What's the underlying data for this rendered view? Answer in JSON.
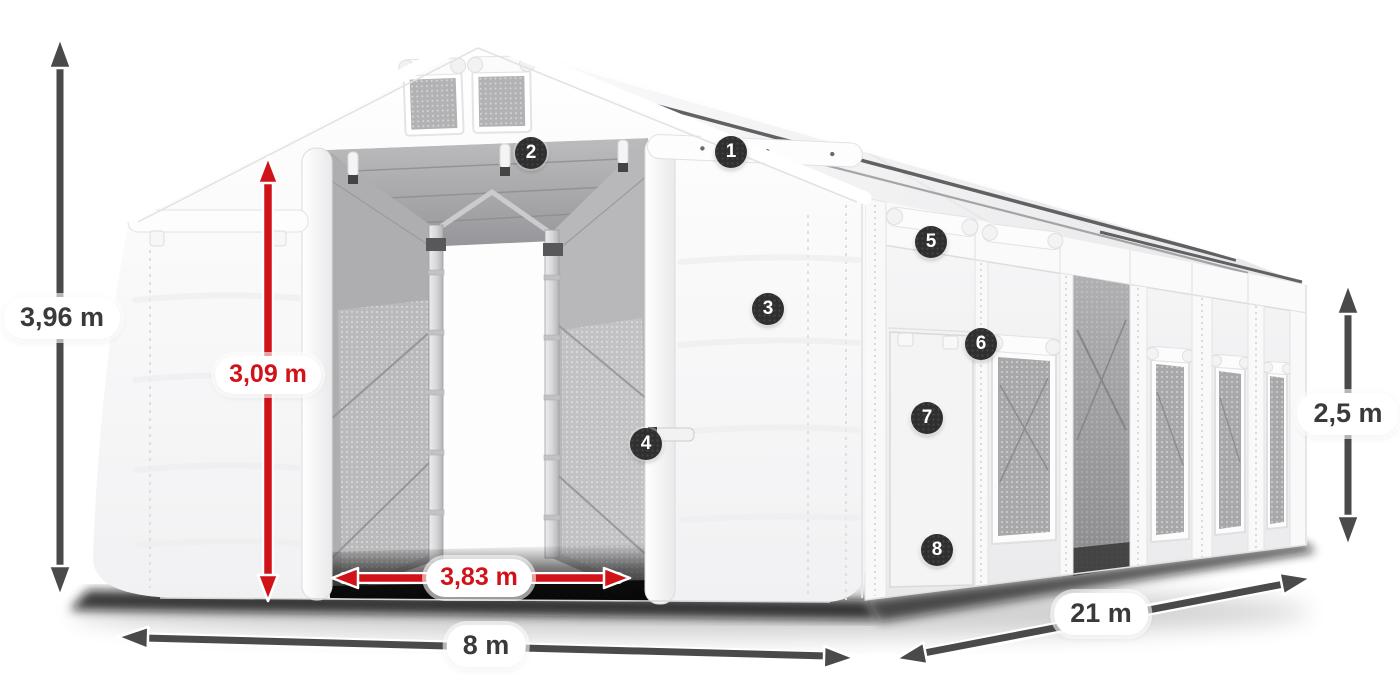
{
  "dimensions": [
    {
      "id": "total-height",
      "value": "3,96 m",
      "style": "dark"
    },
    {
      "id": "door-height",
      "value": "3,09 m",
      "style": "red"
    },
    {
      "id": "door-width",
      "value": "3,83 m",
      "style": "red"
    },
    {
      "id": "front-width",
      "value": "8 m",
      "style": "dark"
    },
    {
      "id": "side-length",
      "value": "21 m",
      "style": "dark"
    },
    {
      "id": "side-height",
      "value": "2,5 m",
      "style": "dark"
    }
  ],
  "callouts": [
    {
      "number": "1"
    },
    {
      "number": "2"
    },
    {
      "number": "3"
    },
    {
      "number": "4"
    },
    {
      "number": "5"
    },
    {
      "number": "6"
    },
    {
      "number": "7"
    },
    {
      "number": "8"
    }
  ],
  "colors": {
    "dimension_arrow": "#4a4a4a",
    "dimension_text": "#3a3a3a",
    "highlight_red": "#d01219",
    "badge_bg": "#2f2f2f",
    "badge_text": "#ffffff",
    "pill_bg": "#ffffff"
  }
}
